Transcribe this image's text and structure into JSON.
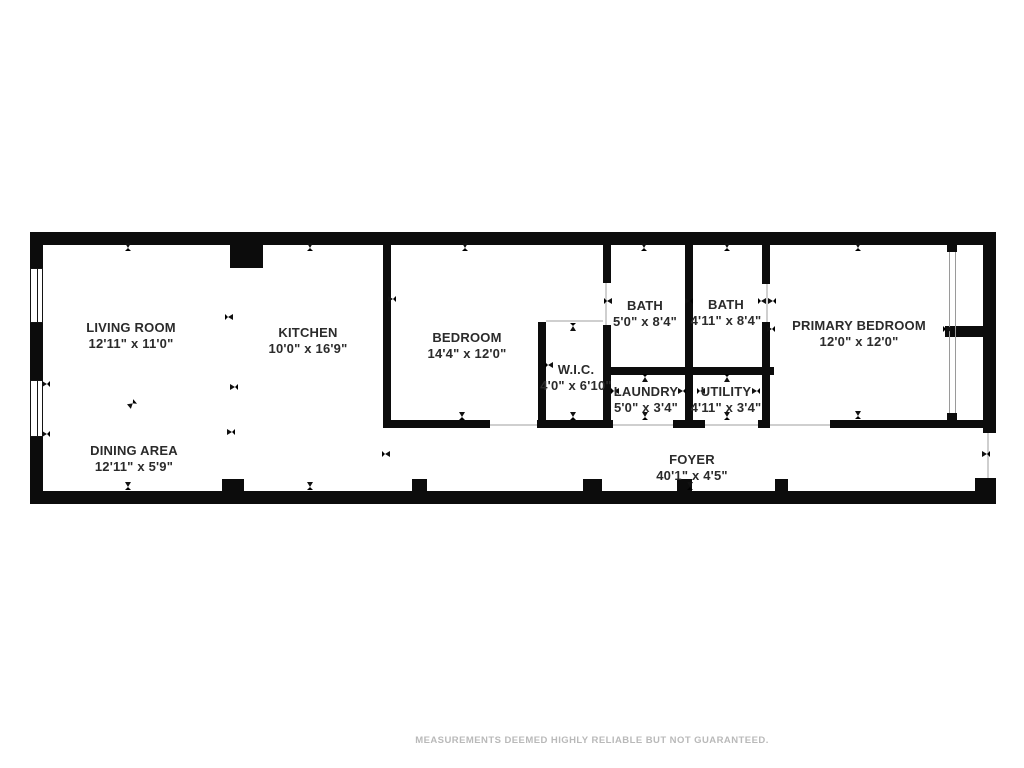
{
  "meta": {
    "footer": "MEASUREMENTS DEEMED HIGHLY RELIABLE BUT NOT GUARANTEED."
  },
  "floorplan": {
    "wall_color": "#0c0c0c",
    "opening_line_color": "#cfcfcf",
    "closet_line_color": "#9a9a9a",
    "rooms": [
      {
        "id": "living-room",
        "name": "LIVING ROOM",
        "dims": "12'11\" x 11'0\"",
        "cx": 131,
        "top": 320
      },
      {
        "id": "kitchen",
        "name": "KITCHEN",
        "dims": "10'0\" x 16'9\"",
        "cx": 308,
        "top": 325
      },
      {
        "id": "bedroom",
        "name": "BEDROOM",
        "dims": "14'4\" x 12'0\"",
        "cx": 467,
        "top": 330
      },
      {
        "id": "wic",
        "name": "W.I.C.",
        "dims": "4'0\" x 6'10\"",
        "cx": 576,
        "top": 362
      },
      {
        "id": "bath-1",
        "name": "BATH",
        "dims": "5'0\" x 8'4\"",
        "cx": 645,
        "top": 298
      },
      {
        "id": "bath-2",
        "name": "BATH",
        "dims": "4'11\" x 8'4\"",
        "cx": 726,
        "top": 297
      },
      {
        "id": "laundry",
        "name": "LAUNDRY",
        "dims": "5'0\" x 3'4\"",
        "cx": 646,
        "top": 384
      },
      {
        "id": "utility",
        "name": "UTILITY",
        "dims": "4'11\" x 3'4\"",
        "cx": 726,
        "top": 384
      },
      {
        "id": "primary-bedroom",
        "name": "PRIMARY BEDROOM",
        "dims": "12'0\" x 12'0\"",
        "cx": 859,
        "top": 318
      },
      {
        "id": "dining-area",
        "name": "DINING AREA",
        "dims": "12'11\" x 5'9\"",
        "cx": 134,
        "top": 443
      },
      {
        "id": "foyer",
        "name": "FOYER",
        "dims": "40'1\" x 4'5\"",
        "cx": 692,
        "top": 452
      }
    ],
    "walls": [
      [
        30,
        232,
        966,
        13
      ],
      [
        30,
        491,
        966,
        13
      ],
      [
        30,
        245,
        13,
        246
      ],
      [
        983,
        245,
        13,
        188
      ],
      [
        975,
        478,
        21,
        13
      ],
      [
        230,
        243,
        33,
        25
      ],
      [
        383,
        245,
        8,
        183
      ],
      [
        538,
        322,
        8,
        106
      ],
      [
        603,
        245,
        8,
        38
      ],
      [
        603,
        325,
        8,
        103
      ],
      [
        685,
        245,
        8,
        183
      ],
      [
        762,
        245,
        8,
        39
      ],
      [
        762,
        322,
        8,
        106
      ],
      [
        603,
        367,
        171,
        8
      ],
      [
        945,
        326,
        38,
        11
      ],
      [
        383,
        420,
        107,
        8
      ],
      [
        537,
        420,
        76,
        8
      ],
      [
        673,
        420,
        32,
        8
      ],
      [
        758,
        420,
        12,
        8
      ],
      [
        830,
        420,
        153,
        8
      ],
      [
        947,
        245,
        10,
        7
      ],
      [
        947,
        413,
        10,
        8
      ],
      [
        222,
        479,
        22,
        13
      ],
      [
        412,
        479,
        15,
        12
      ],
      [
        583,
        479,
        19,
        12
      ],
      [
        677,
        479,
        15,
        12
      ],
      [
        775,
        479,
        13,
        12
      ]
    ],
    "windows": [
      [
        30,
        268,
        13,
        55
      ],
      [
        30,
        380,
        13,
        57
      ]
    ],
    "openings": [
      [
        490,
        424,
        47,
        2,
        "#cfcfcf"
      ],
      [
        613,
        424,
        60,
        2,
        "#cfcfcf"
      ],
      [
        705,
        424,
        53,
        2,
        "#cfcfcf"
      ],
      [
        770,
        424,
        60,
        2,
        "#cfcfcf"
      ],
      [
        546,
        320,
        57,
        2,
        "#cfcfcf"
      ],
      [
        605,
        283,
        2,
        42,
        "#cfcfcf"
      ],
      [
        766,
        284,
        2,
        38,
        "#cfcfcf"
      ],
      [
        987,
        433,
        2,
        45,
        "#cfcfcf"
      ],
      [
        949,
        252,
        1,
        161,
        "#9a9a9a"
      ],
      [
        955,
        252,
        1,
        161,
        "#9a9a9a"
      ]
    ],
    "arrows": [
      [
        128,
        246,
        "down"
      ],
      [
        310,
        246,
        "down"
      ],
      [
        465,
        246,
        "down"
      ],
      [
        644,
        246,
        "down"
      ],
      [
        727,
        246,
        "down"
      ],
      [
        858,
        246,
        "down"
      ],
      [
        858,
        414,
        "down"
      ],
      [
        462,
        415,
        "down"
      ],
      [
        573,
        415,
        "down"
      ],
      [
        645,
        415,
        "down"
      ],
      [
        727,
        415,
        "down"
      ],
      [
        128,
        485,
        "down"
      ],
      [
        310,
        485,
        "down"
      ],
      [
        690,
        485,
        "down"
      ],
      [
        573,
        326,
        "up"
      ],
      [
        645,
        377,
        "up"
      ],
      [
        727,
        377,
        "up"
      ],
      [
        228,
        317,
        "left"
      ],
      [
        548,
        365,
        "left"
      ],
      [
        607,
        301,
        "left"
      ],
      [
        614,
        391,
        "left"
      ],
      [
        700,
        391,
        "left"
      ],
      [
        761,
        301,
        "left"
      ],
      [
        385,
        454,
        "left"
      ],
      [
        946,
        329,
        "left"
      ],
      [
        233,
        387,
        "right"
      ],
      [
        391,
        299,
        "right"
      ],
      [
        688,
        301,
        "right"
      ],
      [
        681,
        391,
        "right"
      ],
      [
        755,
        391,
        "right"
      ],
      [
        771,
        301,
        "right"
      ],
      [
        985,
        454,
        "right"
      ],
      [
        45,
        384,
        "right"
      ],
      [
        45,
        434,
        "right"
      ],
      [
        230,
        432,
        "right"
      ],
      [
        770,
        329,
        "right"
      ],
      [
        131,
        404,
        "ne"
      ]
    ]
  }
}
